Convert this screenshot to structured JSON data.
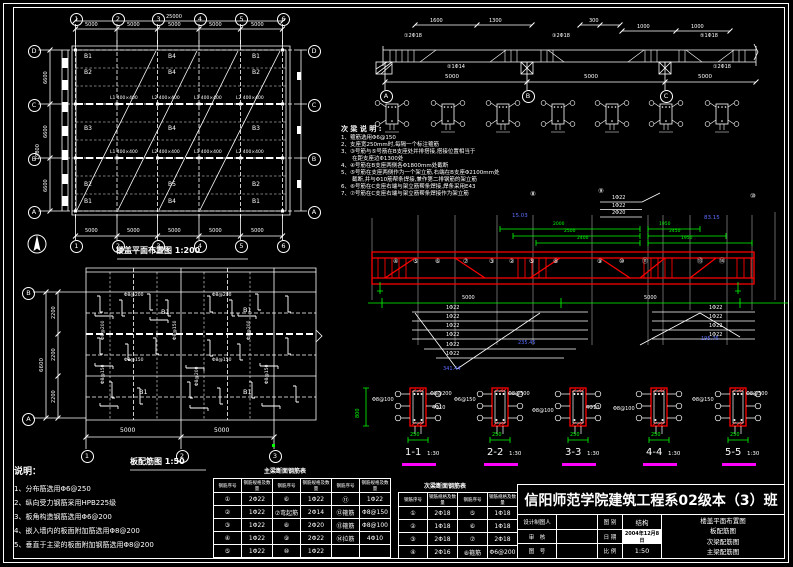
{
  "colors": {
    "bg": "#000000",
    "line": "#ffffff",
    "red": "#ff0000",
    "green": "#00ff00",
    "magenta": "#ff00ff",
    "blue": "#5b6eff"
  },
  "plan_top": {
    "title": "楼盖平面布置图 1:200",
    "col_bubbles": [
      "1",
      "2",
      "3",
      "4",
      "5",
      "6"
    ],
    "row_bubbles": [
      "D",
      "C",
      "B",
      "A"
    ],
    "dim_total_top": "25000",
    "span_dims": [
      "5000",
      "5000",
      "5000",
      "5000",
      "5000"
    ],
    "left_segs": [
      "6600",
      "6600",
      "6600"
    ],
    "left_total": "19800",
    "beam_marks": [
      "L1 400×400",
      "L2 400×400",
      "L1 400×400",
      "L2 400×400"
    ],
    "beam_labels": [
      [
        "B1",
        "B4",
        "B1"
      ],
      [
        "B2",
        "B4",
        "B2"
      ],
      [
        "B3",
        "B4",
        "B3"
      ],
      [
        "B2",
        "B5",
        "B2"
      ],
      [
        "B1",
        "B4",
        "B1"
      ]
    ]
  },
  "plan_bottom": {
    "title": "板配筋图 1:50",
    "col_bubbles": [
      "1",
      "2",
      "3"
    ],
    "row_bubbles": [
      "B",
      "A"
    ],
    "span_dims": [
      "5000",
      "5000"
    ],
    "left_segs": [
      "2200",
      "2200",
      "2200"
    ],
    "left_total": "6600",
    "slab_labels": [
      "B1",
      "B1",
      "B1",
      "B1"
    ],
    "bar_labels": [
      "Φ8@200",
      "Φ8@150",
      "Φ8@200",
      "Φ8@150",
      "Φ8@200",
      "Φ8@150",
      "Φ8@200",
      "Φ8@200",
      "Φ8@150",
      "Φ8@150"
    ]
  },
  "notes_left": {
    "title": "说明：",
    "items": [
      "1、分布筋选用Φ6@250",
      "2、纵向受力钢筋采用HPB225级",
      "3、板角构造钢筋选用Φ6@200",
      "4、嵌入墙内的板面附加筋选用Φ8@200",
      "5、垂直于主梁的板面附加钢筋选用Φ8@200"
    ]
  },
  "notes_beam": {
    "title": "次 梁 说 明 :",
    "items": [
      "1、箍筋选用Φ6@150",
      "2、支座宽250mm时,每隔一个标注箍筋",
      "3、③号筋与⑤号筋在B支座处并排搭接,搭接位置相当于",
      "　　在距支座边Φ1300处",
      "4、④号筋在B支座两侧各Φ1800mm处截断",
      "5、⑤号筋在支座两侧作为一个架立筋,右端在B支座Φ2100mm处",
      "　　截断,并与Φ10筋帮条焊接,兼作第二排钢筋的架立筋",
      "6、⑥号筋在C支座右端与架立筋帮条焊接,焊条采用E43",
      "7、⑦号筋在C支座右端与架立筋帮条焊接作为架立筋"
    ]
  },
  "elev_top": {
    "bubbles": [
      "A",
      "B",
      "C"
    ],
    "top_dims": [
      "1600",
      "1300",
      "300",
      "1000",
      "1000"
    ],
    "span_dims": [
      "5000",
      "5000",
      "5000"
    ],
    "callouts": [
      "①2Φ18",
      "②1Φ14",
      "③2Φ18",
      "⑤1Φ18",
      "①2Φ18"
    ]
  },
  "beam_main": {
    "bar_stack": [
      "1Φ22",
      "1Φ22",
      "2Φ20"
    ],
    "marks_top": [
      "⑧",
      "⑨",
      "⑩"
    ],
    "elev_left": "15.03",
    "elev_right": "83.15",
    "green_dims_left": [
      "2000",
      "2500",
      "2400"
    ],
    "green_dims_right": [
      "1950",
      "2450",
      "1950"
    ],
    "marks": [
      "④",
      "⑤",
      "⑥",
      "⑦",
      "③",
      "②",
      "⑤",
      "⑧",
      "⑨",
      "⑩",
      "⑪",
      "⑬",
      "⑭"
    ],
    "schedule_left": [
      "1Φ22",
      "1Φ22",
      "1Φ22",
      "1Φ22",
      "1Φ22",
      "1Φ22"
    ],
    "schedule_right": [
      "1Φ22",
      "1Φ22",
      "1Φ22",
      "1Φ22"
    ],
    "lengths": [
      "341.44",
      "235.45",
      "195.76"
    ],
    "span_dims": [
      "5000",
      "5000"
    ]
  },
  "sections_main": {
    "scale": "1:30",
    "height_dim": "800",
    "width_dim": "250",
    "items": [
      {
        "label": "1-1",
        "left_note": "Φ8@100",
        "right_note": "Φ8@200",
        "extra": "4Φ10"
      },
      {
        "label": "2-2",
        "left_note": "Φ6@150",
        "right_note": "Φ8@500",
        "extra": ""
      },
      {
        "label": "3-3",
        "left_note": "Φ8@100",
        "right_note": "4Φ10",
        "extra": ""
      },
      {
        "label": "4-4",
        "left_note": "Φ8@100",
        "right_note": "",
        "extra": ""
      },
      {
        "label": "5-5",
        "left_note": "Φ8@150",
        "right_note": "Φ8@500",
        "extra": ""
      }
    ]
  },
  "table_main": {
    "title": "主梁断面钢筋表",
    "headers": [
      "钢筋序号",
      "钢筋规格及数量",
      "钢筋序号",
      "钢筋规格及数量",
      "钢筋序号",
      "钢筋规格及数量"
    ],
    "rows": [
      [
        "①",
        "2Φ22",
        "⑥",
        "1Φ22",
        "⑪",
        "1Φ22"
      ],
      [
        "②",
        "1Φ22",
        "⑦弯起筋",
        "2Φ14",
        "⑫箍筋",
        "Φ8@150"
      ],
      [
        "③",
        "1Φ22",
        "⑧",
        "2Φ20",
        "⑬箍筋",
        "Φ8@100"
      ],
      [
        "④",
        "1Φ22",
        "⑨",
        "2Φ22",
        "⑭拉筋",
        "4Φ10"
      ],
      [
        "⑤",
        "1Φ22",
        "⑩",
        "1Φ22",
        "",
        ""
      ]
    ]
  },
  "table_sec": {
    "title": "次梁断面钢筋表",
    "headers": [
      "钢筋序号",
      "钢筋规格及数量",
      "钢筋序号",
      "钢筋规格及数量"
    ],
    "rows": [
      [
        "①",
        "2Φ18",
        "⑤",
        "1Φ18"
      ],
      [
        "②",
        "1Φ18",
        "⑥",
        "1Φ18"
      ],
      [
        "③",
        "2Φ18",
        "⑦",
        "2Φ18"
      ],
      [
        "④",
        "2Φ16",
        "⑧箍筋",
        "Φ6@200"
      ]
    ]
  },
  "titleblock": {
    "school": "信阳师范学院建筑工程系02级本（3）班",
    "r1k": "设计制图人",
    "r1v": "",
    "r2k": "审　核",
    "r2v": "",
    "r3k": "图　号",
    "r3v": "",
    "c1k": "图 别",
    "c1v": "结构",
    "c2k": "日 期",
    "c2v": "2004年12月8日",
    "c3k": "比 例",
    "c3v": "1:50",
    "sheets": [
      "楼盖平面布置图",
      "板配筋图",
      "次梁配筋图",
      "主梁配筋图"
    ]
  }
}
